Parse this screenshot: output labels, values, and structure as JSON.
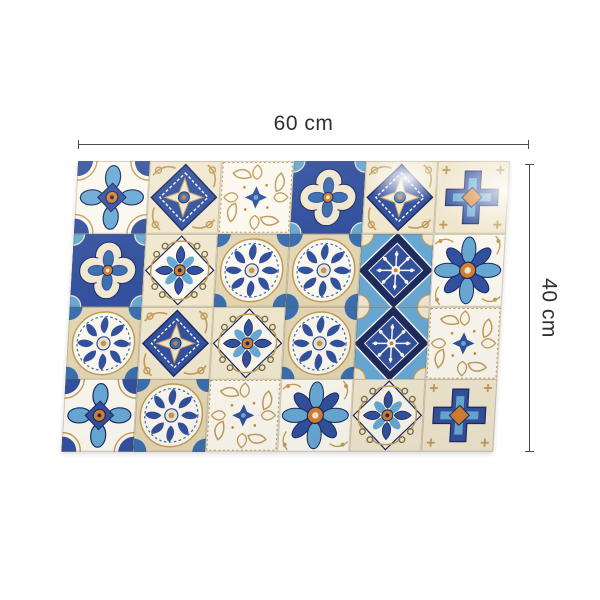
{
  "figure": {
    "width_label": "60 cm",
    "height_label": "40 cm"
  },
  "mat": {
    "description": "patchwork-azulejo-mosaic-tile-mat",
    "columns": 6,
    "rows": 4,
    "tiles": [
      [
        "petal-cross",
        "star-diamond",
        "gold-lattice",
        "quatrefoil",
        "star-diamond",
        "cross-tile"
      ],
      [
        "quatrefoil",
        "scroll-flower",
        "medallion",
        "medallion",
        "navy-snowflake",
        "sky-flower"
      ],
      [
        "medallion",
        "star-diamond",
        "scroll-flower",
        "medallion",
        "navy-snowflake",
        "gold-lattice"
      ],
      [
        "petal-cross",
        "medallion",
        "gold-lattice",
        "sky-flower",
        "scroll-flower",
        "cross-tile"
      ]
    ],
    "palette": {
      "royal_blue": "#33519e",
      "navy": "#1d2b5f",
      "sky_blue": "#68a9d4",
      "steel_blue": "#3c6fae",
      "cream": "#f0e7cf",
      "cream_dark": "#e3d6b4",
      "tan_gold": "#c29c58",
      "orange": "#d48030",
      "olive": "#7c6f42",
      "white": "#fbf8ef"
    },
    "annotation_line_color": "#4a4a4a",
    "annotation_text_color": "#2f2f2f",
    "background": "#ffffff"
  }
}
